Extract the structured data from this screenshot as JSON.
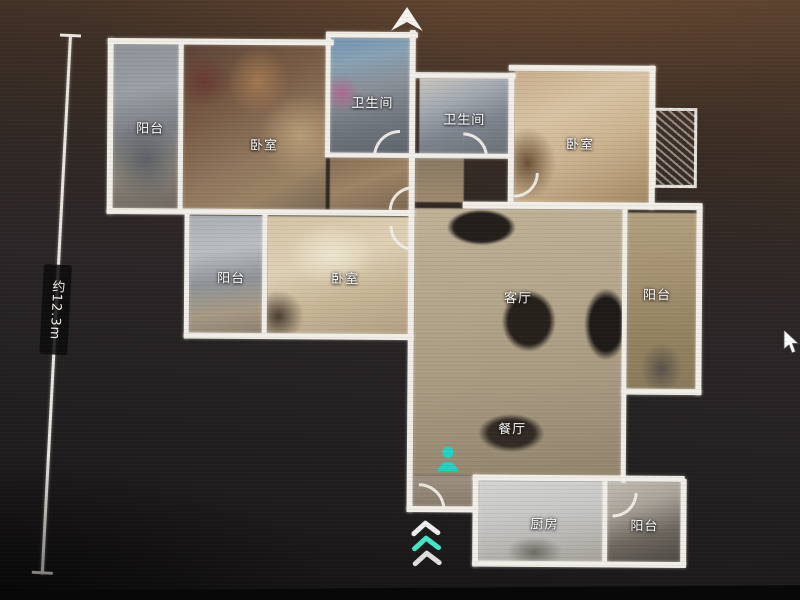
{
  "app": {
    "type": "panorama-floorplan-viewer"
  },
  "dimension_label": "约12.3m",
  "rooms": [
    {
      "id": "balcony-top-left",
      "label": "阳台"
    },
    {
      "id": "bedroom-top-left",
      "label": "卧室"
    },
    {
      "id": "bathroom-top",
      "label": "卫生间"
    },
    {
      "id": "bathroom-inner",
      "label": "卫生间"
    },
    {
      "id": "bedroom-top-right",
      "label": "卧室"
    },
    {
      "id": "balcony-mid-left",
      "label": "阳台"
    },
    {
      "id": "bedroom-mid-left",
      "label": "卧室"
    },
    {
      "id": "living-room",
      "label": "客厅"
    },
    {
      "id": "balcony-right",
      "label": "阳台"
    },
    {
      "id": "dining-room",
      "label": "餐厅"
    },
    {
      "id": "kitchen",
      "label": "厨房"
    },
    {
      "id": "balcony-bottom",
      "label": "阳台"
    }
  ],
  "icons": {
    "compass": "north-arrow-icon",
    "position_marker": "person-silhouette-icon",
    "entrance_indicator": "triple-chevron-up-icon",
    "cursor": "mouse-pointer-icon"
  },
  "colors": {
    "wall_white": "#f1eee8",
    "marker_teal": "#1fd3c5",
    "chevron_teal": "#43e8c6"
  }
}
